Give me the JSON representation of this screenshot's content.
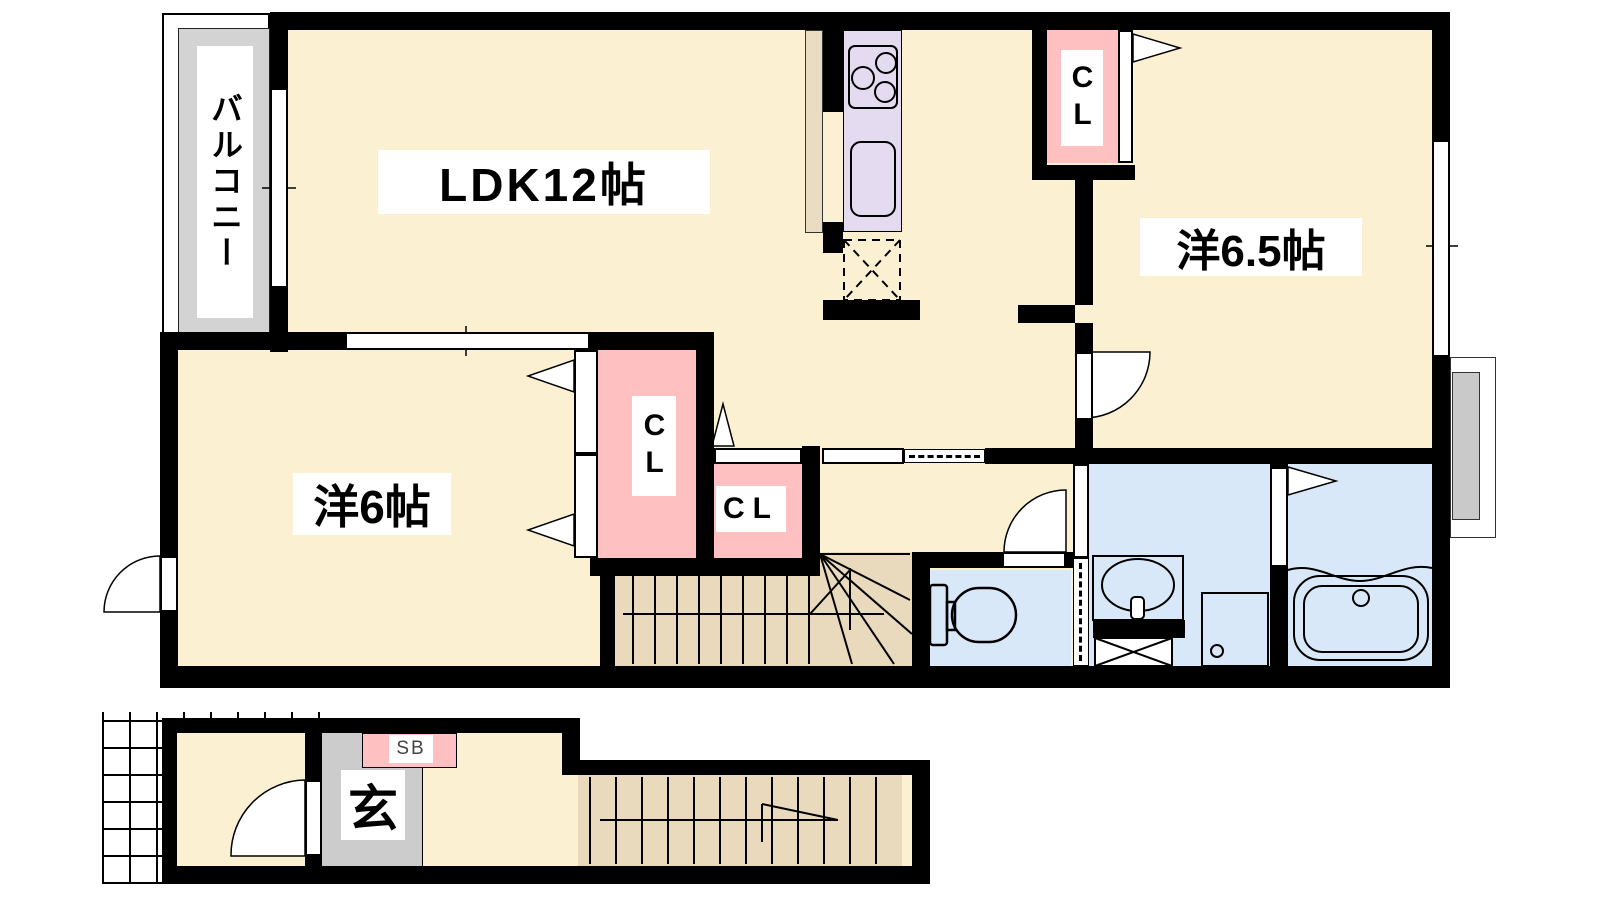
{
  "document_title": "間取り図",
  "floor2": {
    "balcony": "バルコニー",
    "ldk": "LDK12帖",
    "western_room_large": "洋6.5帖",
    "western_room_small": "洋6帖",
    "closet_bedroom1": "CL",
    "closet_hall": "CL",
    "closet_bedroom2": "CL"
  },
  "floor1": {
    "entrance": "玄",
    "shoe_box": "SB"
  },
  "colors": {
    "wall": "#000000",
    "room_floor": "#FCF0D3",
    "wet_room_floor": "#D9E8F8",
    "closet_pink": "#FFC0C1",
    "kitchen_counter": "#E4DBF1",
    "kitchen_side": "#E9DCC3",
    "stairs_tan": "#E9DABD",
    "balcony_gray": "#D3D3D3",
    "entrance_gray": "#CCCCCC"
  }
}
